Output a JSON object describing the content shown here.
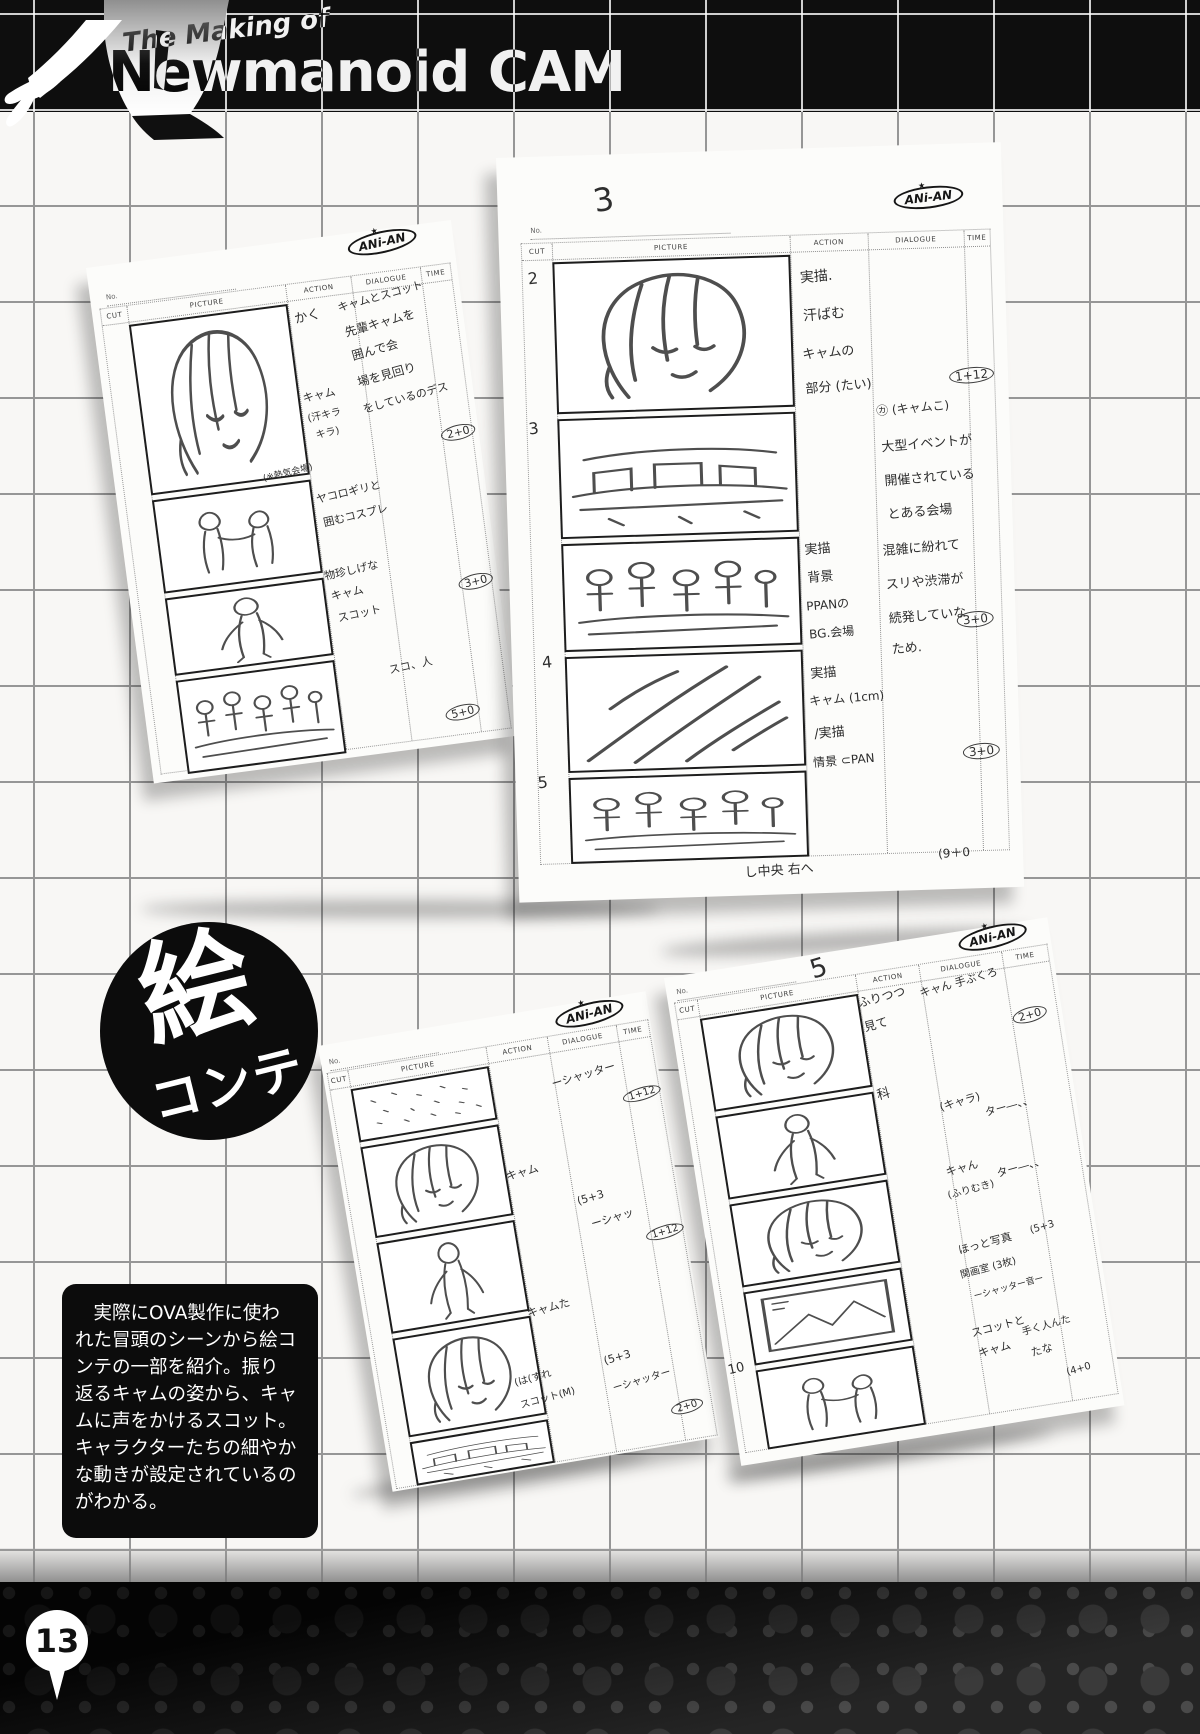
{
  "page": {
    "number": "13"
  },
  "header": {
    "subtitle": "The Making of",
    "title": "Newmanoid CAM"
  },
  "badge": {
    "top": "絵",
    "bottom": "コンテ"
  },
  "info_box": {
    "text": "　実際にOVA製作に使わ\nれた冒頭のシーンから絵コ\nンテの一部を紹介。振り\n返るキャムの姿から、キャ\nムに声をかけるスコット。\nキャラクターたちの細やか\nな動きが設定されているの\nがわかる。"
  },
  "logo": {
    "text": "ANi-AN",
    "star": "★"
  },
  "sheet_headers": {
    "no": "No.",
    "cut": "CUT",
    "picture": "PICTURE",
    "action": "ACTION",
    "dialogue": "DIALOGUE",
    "time": "TIME"
  },
  "sheets": [
    {
      "name": "top-left",
      "annotations": [
        {
          "text": "かく",
          "x": 200,
          "y": 66,
          "r": -6,
          "size": 13
        },
        {
          "text": "キャムとスコット",
          "x": 244,
          "y": 58,
          "r": -8,
          "size": 11
        },
        {
          "text": "先輩キャムを",
          "x": 248,
          "y": 84,
          "r": -8,
          "size": 12
        },
        {
          "text": "囲んで会",
          "x": 252,
          "y": 110,
          "r": -8,
          "size": 12
        },
        {
          "text": "場を見回り",
          "x": 254,
          "y": 136,
          "r": -8,
          "size": 12
        },
        {
          "text": "をしているのデス",
          "x": 256,
          "y": 162,
          "r": -8,
          "size": 11
        },
        {
          "text": "キャム",
          "x": 198,
          "y": 148,
          "r": -5,
          "size": 11
        },
        {
          "text": "(汗キラ",
          "x": 200,
          "y": 168,
          "r": -5,
          "size": 10
        },
        {
          "text": "キラ)",
          "x": 206,
          "y": 186,
          "r": -5,
          "size": 10
        },
        {
          "text": "2+0",
          "x": 330,
          "y": 204,
          "r": -6,
          "size": 11,
          "circled": true
        },
        {
          "text": "(※熱気会場)",
          "x": 148,
          "y": 222,
          "r": -6,
          "size": 9
        },
        {
          "text": "ヤコロギリと",
          "x": 198,
          "y": 248,
          "r": -6,
          "size": 11
        },
        {
          "text": "囲むコスプレ",
          "x": 202,
          "y": 272,
          "r": -6,
          "size": 11
        },
        {
          "text": "物珍しげな",
          "x": 196,
          "y": 326,
          "r": -5,
          "size": 11
        },
        {
          "text": "キャム",
          "x": 200,
          "y": 348,
          "r": -5,
          "size": 11
        },
        {
          "text": "スコット",
          "x": 204,
          "y": 370,
          "r": -5,
          "size": 11
        },
        {
          "text": "3+0",
          "x": 328,
          "y": 354,
          "r": -6,
          "size": 11,
          "circled": true
        },
        {
          "text": "スコ、人",
          "x": 248,
          "y": 428,
          "r": -5,
          "size": 11
        },
        {
          "text": "5+0",
          "x": 298,
          "y": 482,
          "r": -6,
          "size": 11,
          "circled": true
        }
      ]
    },
    {
      "name": "top-right",
      "annotations": [
        {
          "text": "3",
          "x": 96,
          "y": 26,
          "r": -8,
          "size": 32
        },
        {
          "text": "2",
          "x": 28,
          "y": 112,
          "r": -4,
          "size": 16
        },
        {
          "text": "3",
          "x": 24,
          "y": 262,
          "r": -4,
          "size": 16
        },
        {
          "text": "4",
          "x": 30,
          "y": 496,
          "r": -4,
          "size": 16
        },
        {
          "text": "5",
          "x": 22,
          "y": 616,
          "r": -4,
          "size": 16
        },
        {
          "text": "実描.",
          "x": 300,
          "y": 118,
          "r": -3,
          "size": 14
        },
        {
          "text": "汗ばむ",
          "x": 302,
          "y": 156,
          "r": -3,
          "size": 14
        },
        {
          "text": "キャムの",
          "x": 300,
          "y": 194,
          "r": -3,
          "size": 13
        },
        {
          "text": "部分 (たい)",
          "x": 302,
          "y": 228,
          "r": -3,
          "size": 13
        },
        {
          "text": "1+12",
          "x": 446,
          "y": 224,
          "r": -4,
          "size": 12,
          "circled": true
        },
        {
          "text": "㋕ (キャムこ)",
          "x": 372,
          "y": 254,
          "r": -3,
          "size": 12
        },
        {
          "text": "大型イベントが",
          "x": 376,
          "y": 288,
          "r": -3,
          "size": 13
        },
        {
          "text": "開催されている",
          "x": 378,
          "y": 322,
          "r": -3,
          "size": 13
        },
        {
          "text": "とある会場",
          "x": 380,
          "y": 356,
          "r": -3,
          "size": 13
        },
        {
          "text": "実描",
          "x": 296,
          "y": 390,
          "r": -3,
          "size": 13
        },
        {
          "text": "背景",
          "x": 298,
          "y": 418,
          "r": -3,
          "size": 13
        },
        {
          "text": "PPANの",
          "x": 296,
          "y": 448,
          "r": -3,
          "size": 12
        },
        {
          "text": "BG.会場",
          "x": 298,
          "y": 476,
          "r": -3,
          "size": 12
        },
        {
          "text": "混雑に紛れて",
          "x": 374,
          "y": 392,
          "r": -3,
          "size": 13
        },
        {
          "text": "スリや渋滞が",
          "x": 376,
          "y": 426,
          "r": -3,
          "size": 13
        },
        {
          "text": "続発していな",
          "x": 378,
          "y": 460,
          "r": -3,
          "size": 13
        },
        {
          "text": "ため.",
          "x": 380,
          "y": 492,
          "r": -3,
          "size": 13
        },
        {
          "text": "3+0",
          "x": 446,
          "y": 468,
          "r": -4,
          "size": 12,
          "circled": true
        },
        {
          "text": "実描",
          "x": 298,
          "y": 514,
          "r": -3,
          "size": 13
        },
        {
          "text": "キャム (1cm)",
          "x": 296,
          "y": 542,
          "r": -3,
          "size": 12
        },
        {
          "text": "/実描",
          "x": 300,
          "y": 574,
          "r": -3,
          "size": 13
        },
        {
          "text": "情景 ⊂PAN",
          "x": 298,
          "y": 604,
          "r": -3,
          "size": 12
        },
        {
          "text": "3+0",
          "x": 448,
          "y": 600,
          "r": -4,
          "size": 12,
          "circled": true
        },
        {
          "text": "し中央 右へ",
          "x": 226,
          "y": 710,
          "r": -2,
          "size": 13
        },
        {
          "text": "(9＋0",
          "x": 420,
          "y": 700,
          "r": -2,
          "size": 12
        }
      ]
    },
    {
      "name": "bottom-middle",
      "annotations": [
        {
          "text": "ーシャッター",
          "x": 224,
          "y": 64,
          "r": -7,
          "size": 11
        },
        {
          "text": "1+12",
          "x": 292,
          "y": 94,
          "r": -7,
          "size": 10,
          "circled": true
        },
        {
          "text": "キャム",
          "x": 164,
          "y": 150,
          "r": -6,
          "size": 11
        },
        {
          "text": "(5+3",
          "x": 230,
          "y": 188,
          "r": -7,
          "size": 11
        },
        {
          "text": "ーシャッ",
          "x": 240,
          "y": 210,
          "r": -7,
          "size": 11
        },
        {
          "text": "1+12",
          "x": 292,
          "y": 234,
          "r": -7,
          "size": 10,
          "circled": true
        },
        {
          "text": "キャムた",
          "x": 162,
          "y": 288,
          "r": -6,
          "size": 11
        },
        {
          "text": "(は(すれ",
          "x": 138,
          "y": 354,
          "r": -6,
          "size": 10
        },
        {
          "text": "スコット(M)",
          "x": 140,
          "y": 376,
          "r": -6,
          "size": 10
        },
        {
          "text": "(5+3",
          "x": 230,
          "y": 350,
          "r": -7,
          "size": 11
        },
        {
          "text": "ーシャッター",
          "x": 234,
          "y": 374,
          "r": -7,
          "size": 10
        },
        {
          "text": "2+0",
          "x": 288,
          "y": 410,
          "r": -7,
          "size": 10,
          "circled": true
        }
      ]
    },
    {
      "name": "bottom-right",
      "annotations": [
        {
          "text": "5",
          "x": 146,
          "y": 0,
          "r": -8,
          "size": 26
        },
        {
          "text": "ふりつつ",
          "x": 188,
          "y": 44,
          "r": -6,
          "size": 12
        },
        {
          "text": "見て",
          "x": 190,
          "y": 70,
          "r": -6,
          "size": 12
        },
        {
          "text": "キャん 手ぶくろ",
          "x": 250,
          "y": 42,
          "r": -7,
          "size": 11
        },
        {
          "text": "2+0",
          "x": 338,
          "y": 86,
          "r": -7,
          "size": 11,
          "circled": true
        },
        {
          "text": "科",
          "x": 192,
          "y": 138,
          "r": -6,
          "size": 13
        },
        {
          "text": "(キャラ)",
          "x": 252,
          "y": 160,
          "r": -7,
          "size": 11
        },
        {
          "text": "ター―、、",
          "x": 296,
          "y": 172,
          "r": -7,
          "size": 11
        },
        {
          "text": "キャん",
          "x": 248,
          "y": 226,
          "r": -6,
          "size": 11
        },
        {
          "text": "(ふりむき)",
          "x": 246,
          "y": 248,
          "r": -6,
          "size": 10
        },
        {
          "text": "ター―、、",
          "x": 298,
          "y": 234,
          "r": -7,
          "size": 11
        },
        {
          "text": "ほっと写真",
          "x": 248,
          "y": 304,
          "r": -6,
          "size": 11
        },
        {
          "text": "(5+3",
          "x": 322,
          "y": 300,
          "r": -7,
          "size": 10
        },
        {
          "text": "関画室 (3枚)",
          "x": 246,
          "y": 328,
          "r": -6,
          "size": 10
        },
        {
          "text": "ーシャッター音ー",
          "x": 256,
          "y": 352,
          "r": -6,
          "size": 9
        },
        {
          "text": "10",
          "x": 2,
          "y": 390,
          "r": -4,
          "size": 13
        },
        {
          "text": "スコットと",
          "x": 248,
          "y": 388,
          "r": -6,
          "size": 11
        },
        {
          "text": "キャム",
          "x": 252,
          "y": 410,
          "r": -6,
          "size": 11
        },
        {
          "text": "手く人んた",
          "x": 298,
          "y": 394,
          "r": -7,
          "size": 10
        },
        {
          "text": "たな",
          "x": 304,
          "y": 418,
          "r": -7,
          "size": 11
        },
        {
          "text": "(4+0",
          "x": 336,
          "y": 446,
          "r": -7,
          "size": 10
        }
      ]
    }
  ]
}
